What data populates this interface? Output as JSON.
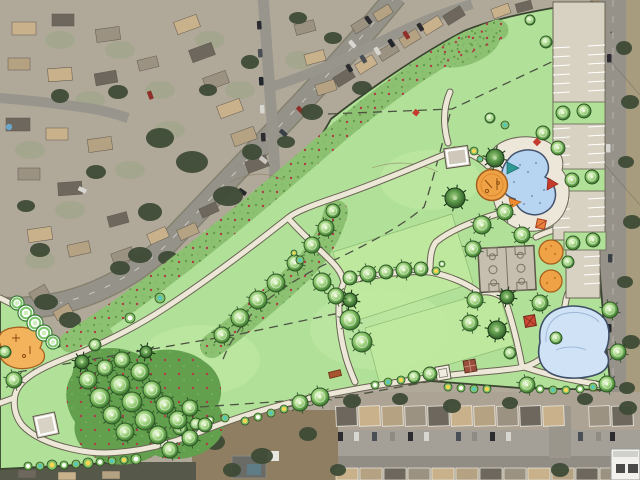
{
  "scene": {
    "kind": "park-master-plan-rendering-over-aerial-photo",
    "width_px": 640,
    "height_px": 480,
    "visible_text": ""
  },
  "colors": {
    "lawn": "#b1e099",
    "lawn_panel": "#c0ea9f",
    "meadow": "#8cc171",
    "understory": "#63a04e",
    "path_fill": "#ece7d6",
    "path_casing": "#6a6454",
    "deck": "#ece7d8",
    "pool_water": "#b7d4f0",
    "pond_water": "#cfe2f6",
    "water_outline": "#3f4f68",
    "court_surface": "#c6bfb0",
    "parking_surface": "#d8d2c2",
    "playground_orange": "#f0a246",
    "playground_outline": "#a5601f",
    "shelter_red": "#cc4a33",
    "shelter_orange": "#e8823c",
    "tree_ring_dark": "#2c5226",
    "tree_mid": "#7dbb5e",
    "tree_light": "#bfe5a0",
    "red_meadow_dot": "#b03a46",
    "boundary_line": "#39452f",
    "dashed_easement": "#4d5243",
    "aerial_base": "#b0a899",
    "aerial_road": "#95928a",
    "aerial_verge": "#a89c7e",
    "aerial_dirt": "#8f7e61",
    "roof_tan": "#c9b28b",
    "roof_gray": "#9c9282",
    "roof_dark": "#6e675d",
    "roof_brown": "#b5a282",
    "dark_tree_blob": "#3e4b36",
    "car_red": "#8e2f2a",
    "inset_white": "#f2f1ee"
  },
  "features": [
    {
      "name": "aerial-neighborhood",
      "kind": "photo-background"
    },
    {
      "name": "curving-avenue",
      "kind": "road"
    },
    {
      "name": "park-lawn",
      "kind": "open-turf"
    },
    {
      "name": "wildflower-meadow-strip",
      "kind": "planting"
    },
    {
      "name": "walking-trail-loop",
      "kind": "path"
    },
    {
      "name": "splash-pad",
      "kind": "pool-with-shade-sails"
    },
    {
      "name": "playground-circle-large",
      "kind": "playground"
    },
    {
      "name": "playground-circles-small",
      "kind": "playground"
    },
    {
      "name": "basketball-courts",
      "kind": "sport-court"
    },
    {
      "name": "parking-lot",
      "kind": "parking"
    },
    {
      "name": "pond",
      "kind": "water"
    },
    {
      "name": "picnic-shelters",
      "kind": "site-furnishing"
    },
    {
      "name": "open-play-fields",
      "kind": "turf-panel"
    },
    {
      "name": "utility-easement",
      "kind": "dashed-line"
    },
    {
      "name": "scale-inset",
      "kind": "map-graphic"
    }
  ]
}
